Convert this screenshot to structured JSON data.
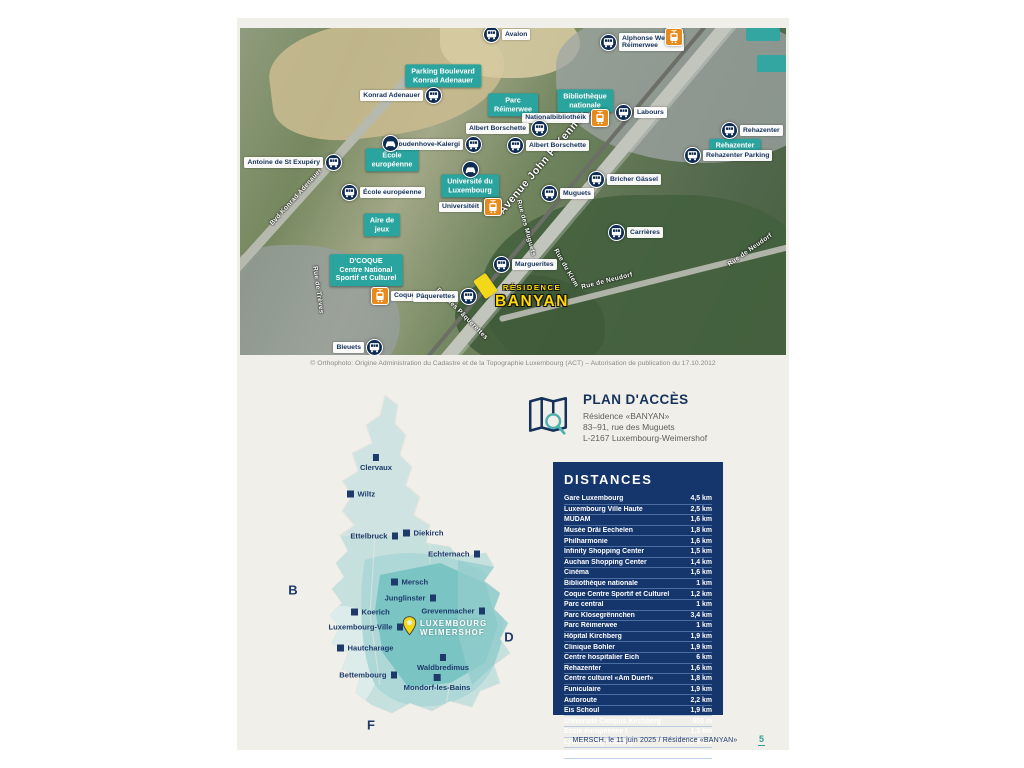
{
  "map": {
    "copyright": "© Orthophoto: Origine Administration du Cadastre et de la Topographie Luxembourg (ACT) – Autorisation de publication du 17.10.2012",
    "residence": {
      "line1": "RÉSIDENCE",
      "line2": "BANYAN"
    },
    "stops": [
      {
        "type": "bus",
        "x": 252,
        "y": 7,
        "side": "right",
        "lines": [
          "Avalon"
        ]
      },
      {
        "type": "bus",
        "x": 369,
        "y": 14,
        "side": "right",
        "lines": [
          "Alphonse Weicker",
          "Réimerwee"
        ]
      },
      {
        "type": "tram",
        "x": 434,
        "y": 9,
        "side": "right",
        "lines": []
      },
      {
        "type": "bus",
        "x": 193,
        "y": 68,
        "side": "left",
        "lines": [
          "Konrad Adenauer"
        ]
      },
      {
        "type": "tram",
        "x": 360,
        "y": 90,
        "side": "left",
        "lines": [
          "Nationalbibliothéik"
        ]
      },
      {
        "type": "bus",
        "x": 299,
        "y": 101,
        "side": "left",
        "lines": [
          "Albert Borschette"
        ]
      },
      {
        "type": "bus",
        "x": 276,
        "y": 118,
        "side": "right",
        "lines": [
          "Albert Borschette"
        ]
      },
      {
        "type": "bus",
        "x": 384,
        "y": 85,
        "side": "right",
        "lines": [
          "Labours"
        ]
      },
      {
        "type": "bus",
        "x": 490,
        "y": 103,
        "side": "right",
        "lines": [
          "Rehazenter"
        ]
      },
      {
        "type": "bus",
        "x": 453,
        "y": 128,
        "side": "right",
        "lines": [
          "Rehazenter Parking"
        ]
      },
      {
        "type": "bus",
        "x": 93,
        "y": 135,
        "side": "left",
        "lines": [
          "Antoine de St Exupéry"
        ]
      },
      {
        "type": "bus",
        "x": 233,
        "y": 117,
        "side": "left",
        "lines": [
          "Coudenhove-Kalergi"
        ]
      },
      {
        "type": "car",
        "x": 151,
        "y": 116,
        "side": "right",
        "lines": []
      },
      {
        "type": "car",
        "x": 231,
        "y": 142,
        "side": "right",
        "lines": []
      },
      {
        "type": "bus",
        "x": 110,
        "y": 165,
        "side": "right",
        "lines": [
          "École européenne"
        ]
      },
      {
        "type": "tram",
        "x": 253,
        "y": 179,
        "side": "left",
        "lines": [
          "Universitéit"
        ]
      },
      {
        "type": "bus",
        "x": 357,
        "y": 152,
        "side": "right",
        "lines": [
          "Bricher Gässel"
        ]
      },
      {
        "type": "bus",
        "x": 310,
        "y": 166,
        "side": "right",
        "lines": [
          "Muguets"
        ]
      },
      {
        "type": "bus",
        "x": 377,
        "y": 205,
        "side": "right",
        "lines": [
          "Carrières"
        ]
      },
      {
        "type": "tram",
        "x": 140,
        "y": 268,
        "side": "right",
        "lines": [
          "Coque"
        ]
      },
      {
        "type": "bus",
        "x": 228,
        "y": 269,
        "side": "left",
        "lines": [
          "Pâquerettes"
        ]
      },
      {
        "type": "bus",
        "x": 262,
        "y": 237,
        "side": "right",
        "lines": [
          "Marguerites"
        ]
      },
      {
        "type": "bus",
        "x": 134,
        "y": 320,
        "side": "left",
        "lines": [
          "Bleuets"
        ]
      }
    ],
    "poi_boxes": [
      {
        "x": 203,
        "y": 48,
        "lines": [
          "Parking Boulevard",
          "Konrad Adenauer"
        ]
      },
      {
        "x": 273,
        "y": 77,
        "lines": [
          "Parc",
          "Réimerwee"
        ]
      },
      {
        "x": 345,
        "y": 73,
        "lines": [
          "Bibliothèque",
          "nationale"
        ]
      },
      {
        "x": 495,
        "y": 118,
        "lines": [
          "Rehazenter"
        ]
      },
      {
        "x": 152,
        "y": 132,
        "lines": [
          "École",
          "européenne"
        ]
      },
      {
        "x": 230,
        "y": 158,
        "lines": [
          "Université du",
          "Luxembourg"
        ]
      },
      {
        "x": 142,
        "y": 197,
        "lines": [
          "Aire de",
          "jeux"
        ]
      },
      {
        "x": 126,
        "y": 242,
        "lines": [
          "D'COQUE",
          "Centre National",
          "Sportif et Culturel"
        ]
      }
    ],
    "streets": [
      {
        "x": 305,
        "y": 132,
        "rot": -50,
        "major": true,
        "label": "Avenue John F. Kennedy"
      },
      {
        "x": 56,
        "y": 169,
        "rot": -48,
        "major": false,
        "label": "Bvd Konrad Adenauer"
      },
      {
        "x": 286,
        "y": 200,
        "rot": 75,
        "major": false,
        "label": "Rue des Muguets"
      },
      {
        "x": 326,
        "y": 240,
        "rot": 60,
        "major": false,
        "label": "Rue du Kiem"
      },
      {
        "x": 367,
        "y": 253,
        "rot": -14,
        "major": false,
        "label": "Rue de Neudorf"
      },
      {
        "x": 510,
        "y": 222,
        "rot": -35,
        "major": false,
        "label": "Rue de Neudorf"
      },
      {
        "x": 222,
        "y": 286,
        "rot": 45,
        "major": false,
        "label": "Rue des Pâquerettes"
      },
      {
        "x": 78,
        "y": 262,
        "rot": 82,
        "major": false,
        "label": "Rue de Trèves"
      }
    ]
  },
  "access": {
    "title": "PLAN D'ACCÈS",
    "lines": [
      "Résidence «BANYAN»",
      "83–91, rue des Muguets",
      "L-2167 Luxembourg-Weimershof"
    ]
  },
  "distances": {
    "title": "DISTANCES",
    "rows": [
      {
        "name": "Gare Luxembourg",
        "value": "4,5 km",
        "plane": false
      },
      {
        "name": "Luxembourg Ville Haute",
        "value": "2,5 km",
        "plane": false
      },
      {
        "name": "MUDAM",
        "value": "1,6 km",
        "plane": false
      },
      {
        "name": "Musée Dräi Eechelen",
        "value": "1,8 km",
        "plane": false
      },
      {
        "name": "Philharmonie",
        "value": "1,6 km",
        "plane": false
      },
      {
        "name": "Infinity Shopping Center",
        "value": "1,5 km",
        "plane": false
      },
      {
        "name": "Auchan Shopping Center",
        "value": "1,4 km",
        "plane": false
      },
      {
        "name": "Cinéma",
        "value": "1,6 km",
        "plane": false
      },
      {
        "name": "Bibliothèque nationale",
        "value": "1 km",
        "plane": false
      },
      {
        "name": "Coque Centre Sportif et Culturel",
        "value": "1,2 km",
        "plane": false
      },
      {
        "name": "Parc central",
        "value": "1 km",
        "plane": false
      },
      {
        "name": "Parc Klosegrënnchen",
        "value": "3,4 km",
        "plane": false
      },
      {
        "name": "Parc Réimerwee",
        "value": "1 km",
        "plane": false
      },
      {
        "name": "Hôpital Kirchberg",
        "value": "1,9 km",
        "plane": false
      },
      {
        "name": "Clinique Bohler",
        "value": "1,9 km",
        "plane": false
      },
      {
        "name": "Centre hospitalier Eich",
        "value": "6 km",
        "plane": false
      },
      {
        "name": "Rehazenter",
        "value": "1,6 km",
        "plane": false
      },
      {
        "name": "Centre culturel «Am Duerf»",
        "value": "1,8 km",
        "plane": false
      },
      {
        "name": "Funiculaire",
        "value": "1,9 km",
        "plane": false
      },
      {
        "name": "Autoroute",
        "value": "2,2 km",
        "plane": false
      },
      {
        "name": "Eis Schoul",
        "value": "1,9 km",
        "plane": false
      },
      {
        "name": "Université Campus Kirchberg",
        "value": "800 m",
        "plane": false
      },
      {
        "name": "École européenne I",
        "value": "1,3 km",
        "plane": false
      },
      {
        "name": "Lycées Limpertsberg",
        "value": "ca. 3 km",
        "plane": false
      },
      {
        "name": "Luxexpo The Box",
        "value": "2,1 km",
        "plane": false
      },
      {
        "name": "Clausen",
        "value": "2,1 km",
        "plane": false
      },
      {
        "name": "Aéroport Findel",
        "value": "6 km",
        "plane": true
      }
    ]
  },
  "lux_map": {
    "cities": [
      {
        "label": "Clervaux",
        "x": 96,
        "y": 73,
        "side": "below"
      },
      {
        "label": "Wiltz",
        "x": 71,
        "y": 109,
        "side": "right"
      },
      {
        "label": "Ettelbruck",
        "x": 114,
        "y": 151,
        "side": "left"
      },
      {
        "label": "Diekirch",
        "x": 127,
        "y": 148,
        "side": "right"
      },
      {
        "label": "Echternach",
        "x": 196,
        "y": 169,
        "side": "left"
      },
      {
        "label": "Mersch",
        "x": 115,
        "y": 197,
        "side": "right"
      },
      {
        "label": "Junglinster",
        "x": 152,
        "y": 213,
        "side": "left"
      },
      {
        "label": "Grevenmacher",
        "x": 201,
        "y": 226,
        "side": "left"
      },
      {
        "label": "Koerich",
        "x": 75,
        "y": 227,
        "side": "right"
      },
      {
        "label": "Luxembourg-Ville",
        "x": 119,
        "y": 242,
        "side": "left"
      },
      {
        "label": "Hautcharage",
        "x": 61,
        "y": 263,
        "side": "right"
      },
      {
        "label": "Waldbredimus",
        "x": 163,
        "y": 273,
        "side": "below"
      },
      {
        "label": "Bettembourg",
        "x": 113,
        "y": 290,
        "side": "left"
      },
      {
        "label": "Mondorf-les-Bains",
        "x": 157,
        "y": 293,
        "side": "below"
      }
    ],
    "countries": [
      {
        "label": "B",
        "x": 13,
        "y": 205
      },
      {
        "label": "D",
        "x": 229,
        "y": 252
      },
      {
        "label": "F",
        "x": 91,
        "y": 340
      }
    ],
    "highlight": {
      "line1": "LUXEMBOURG",
      "line2": "WEIMERSHOF"
    }
  },
  "footer": {
    "text": "MERSCH, le 11 juin 2025  /  Résidence «BANYAN»",
    "page": "5"
  }
}
